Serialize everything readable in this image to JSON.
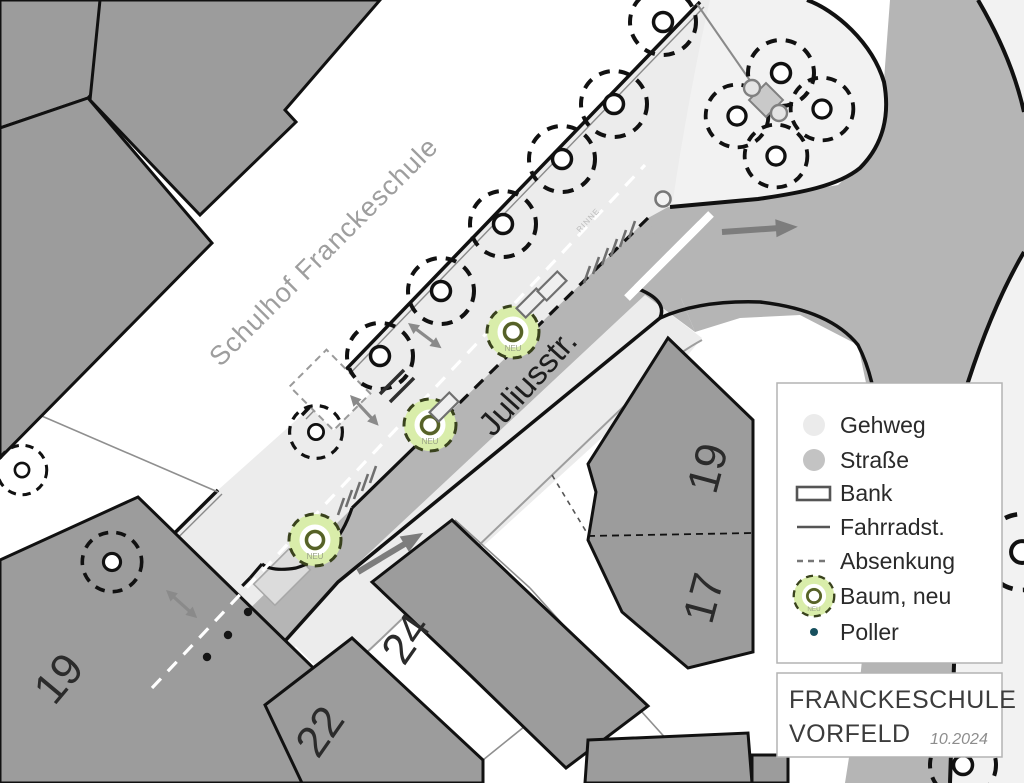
{
  "map": {
    "schoolyard_label": "Schulhof Franckeschule",
    "street_label": "Juliusstr.",
    "gutter_label": "RINNE",
    "new_tree_label": "NEU",
    "house_numbers": {
      "left_19": "19",
      "h22": "22",
      "h24": "24",
      "right_19": "19",
      "right_17": "17"
    }
  },
  "legend": {
    "items": [
      {
        "label": "Gehweg",
        "symbol": "sidewalk-dot"
      },
      {
        "label": "Straße",
        "symbol": "street-dot"
      },
      {
        "label": "Bank",
        "symbol": "bench-rect"
      },
      {
        "label": "Fahrradst.",
        "symbol": "bike-stand-line"
      },
      {
        "label": "Absenkung",
        "symbol": "dashed-line"
      },
      {
        "label": "Baum, neu",
        "symbol": "new-tree"
      },
      {
        "label": "Poller",
        "symbol": "bollard-dot"
      }
    ]
  },
  "title_block": {
    "project": "FRANCKESCHULE",
    "area": "VORFELD",
    "date": "10.2024"
  },
  "colors": {
    "sidewalk": "#ececec",
    "island": "#f2f2f2",
    "street": "#b5b5b5",
    "building": "#9c9c9c",
    "tree_new_fill": "#d9edaa",
    "poller_legend": "#17505e",
    "outline": "#111111"
  }
}
